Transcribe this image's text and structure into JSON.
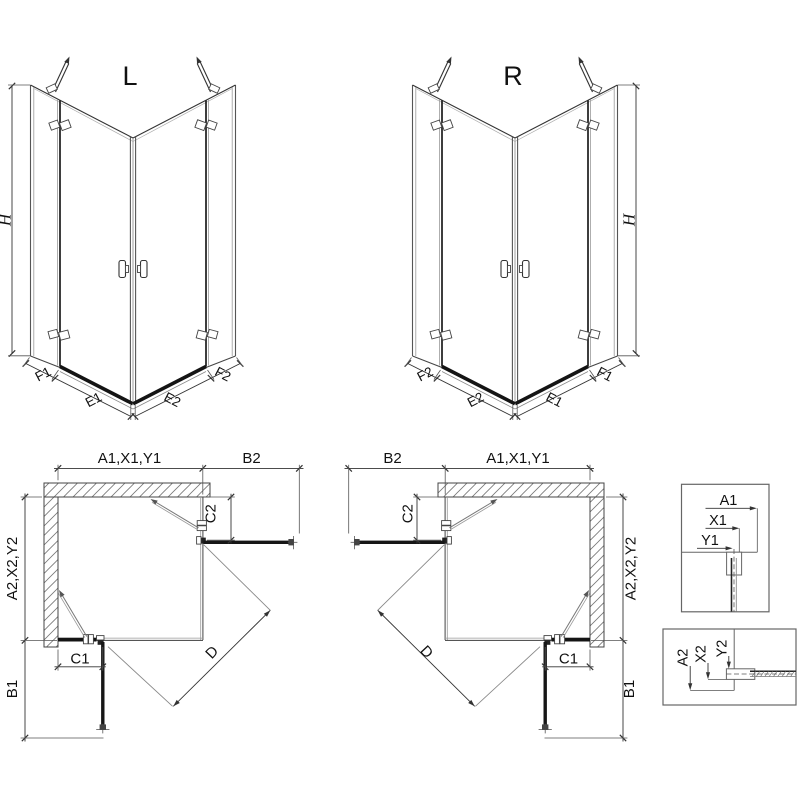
{
  "views": {
    "iso_left": {
      "label": "L",
      "height": "H",
      "base": [
        "F1",
        "E1",
        "E2",
        "F2"
      ]
    },
    "iso_right": {
      "label": "R",
      "height": "H",
      "base": [
        "F2",
        "E2",
        "E1",
        "F1"
      ]
    },
    "plan_left": {
      "width_main": "A1,X1,Y1",
      "width_door": "B2",
      "depth_main": "A2,X2,Y2",
      "depth_door": "B1",
      "fixed_top": "C2",
      "fixed_bottom": "C1",
      "diagonal": "D"
    },
    "plan_right": {
      "width_main": "A1,X1,Y1",
      "width_door": "B2",
      "depth_main": "A2,X2,Y2",
      "depth_door": "B1",
      "fixed_top": "C2",
      "fixed_bottom": "C1",
      "diagonal": "D"
    },
    "detail_top": {
      "dims": [
        "A1",
        "X1",
        "Y1"
      ]
    },
    "detail_bottom": {
      "dims": [
        "A2",
        "X2",
        "Y2"
      ]
    }
  },
  "colors": {
    "line": "#333333",
    "glass_dark": "#555555",
    "glass_light": "#999999",
    "panel_dark": "#161616",
    "hatch": "#777777",
    "text": "#111111",
    "background": "#ffffff"
  }
}
